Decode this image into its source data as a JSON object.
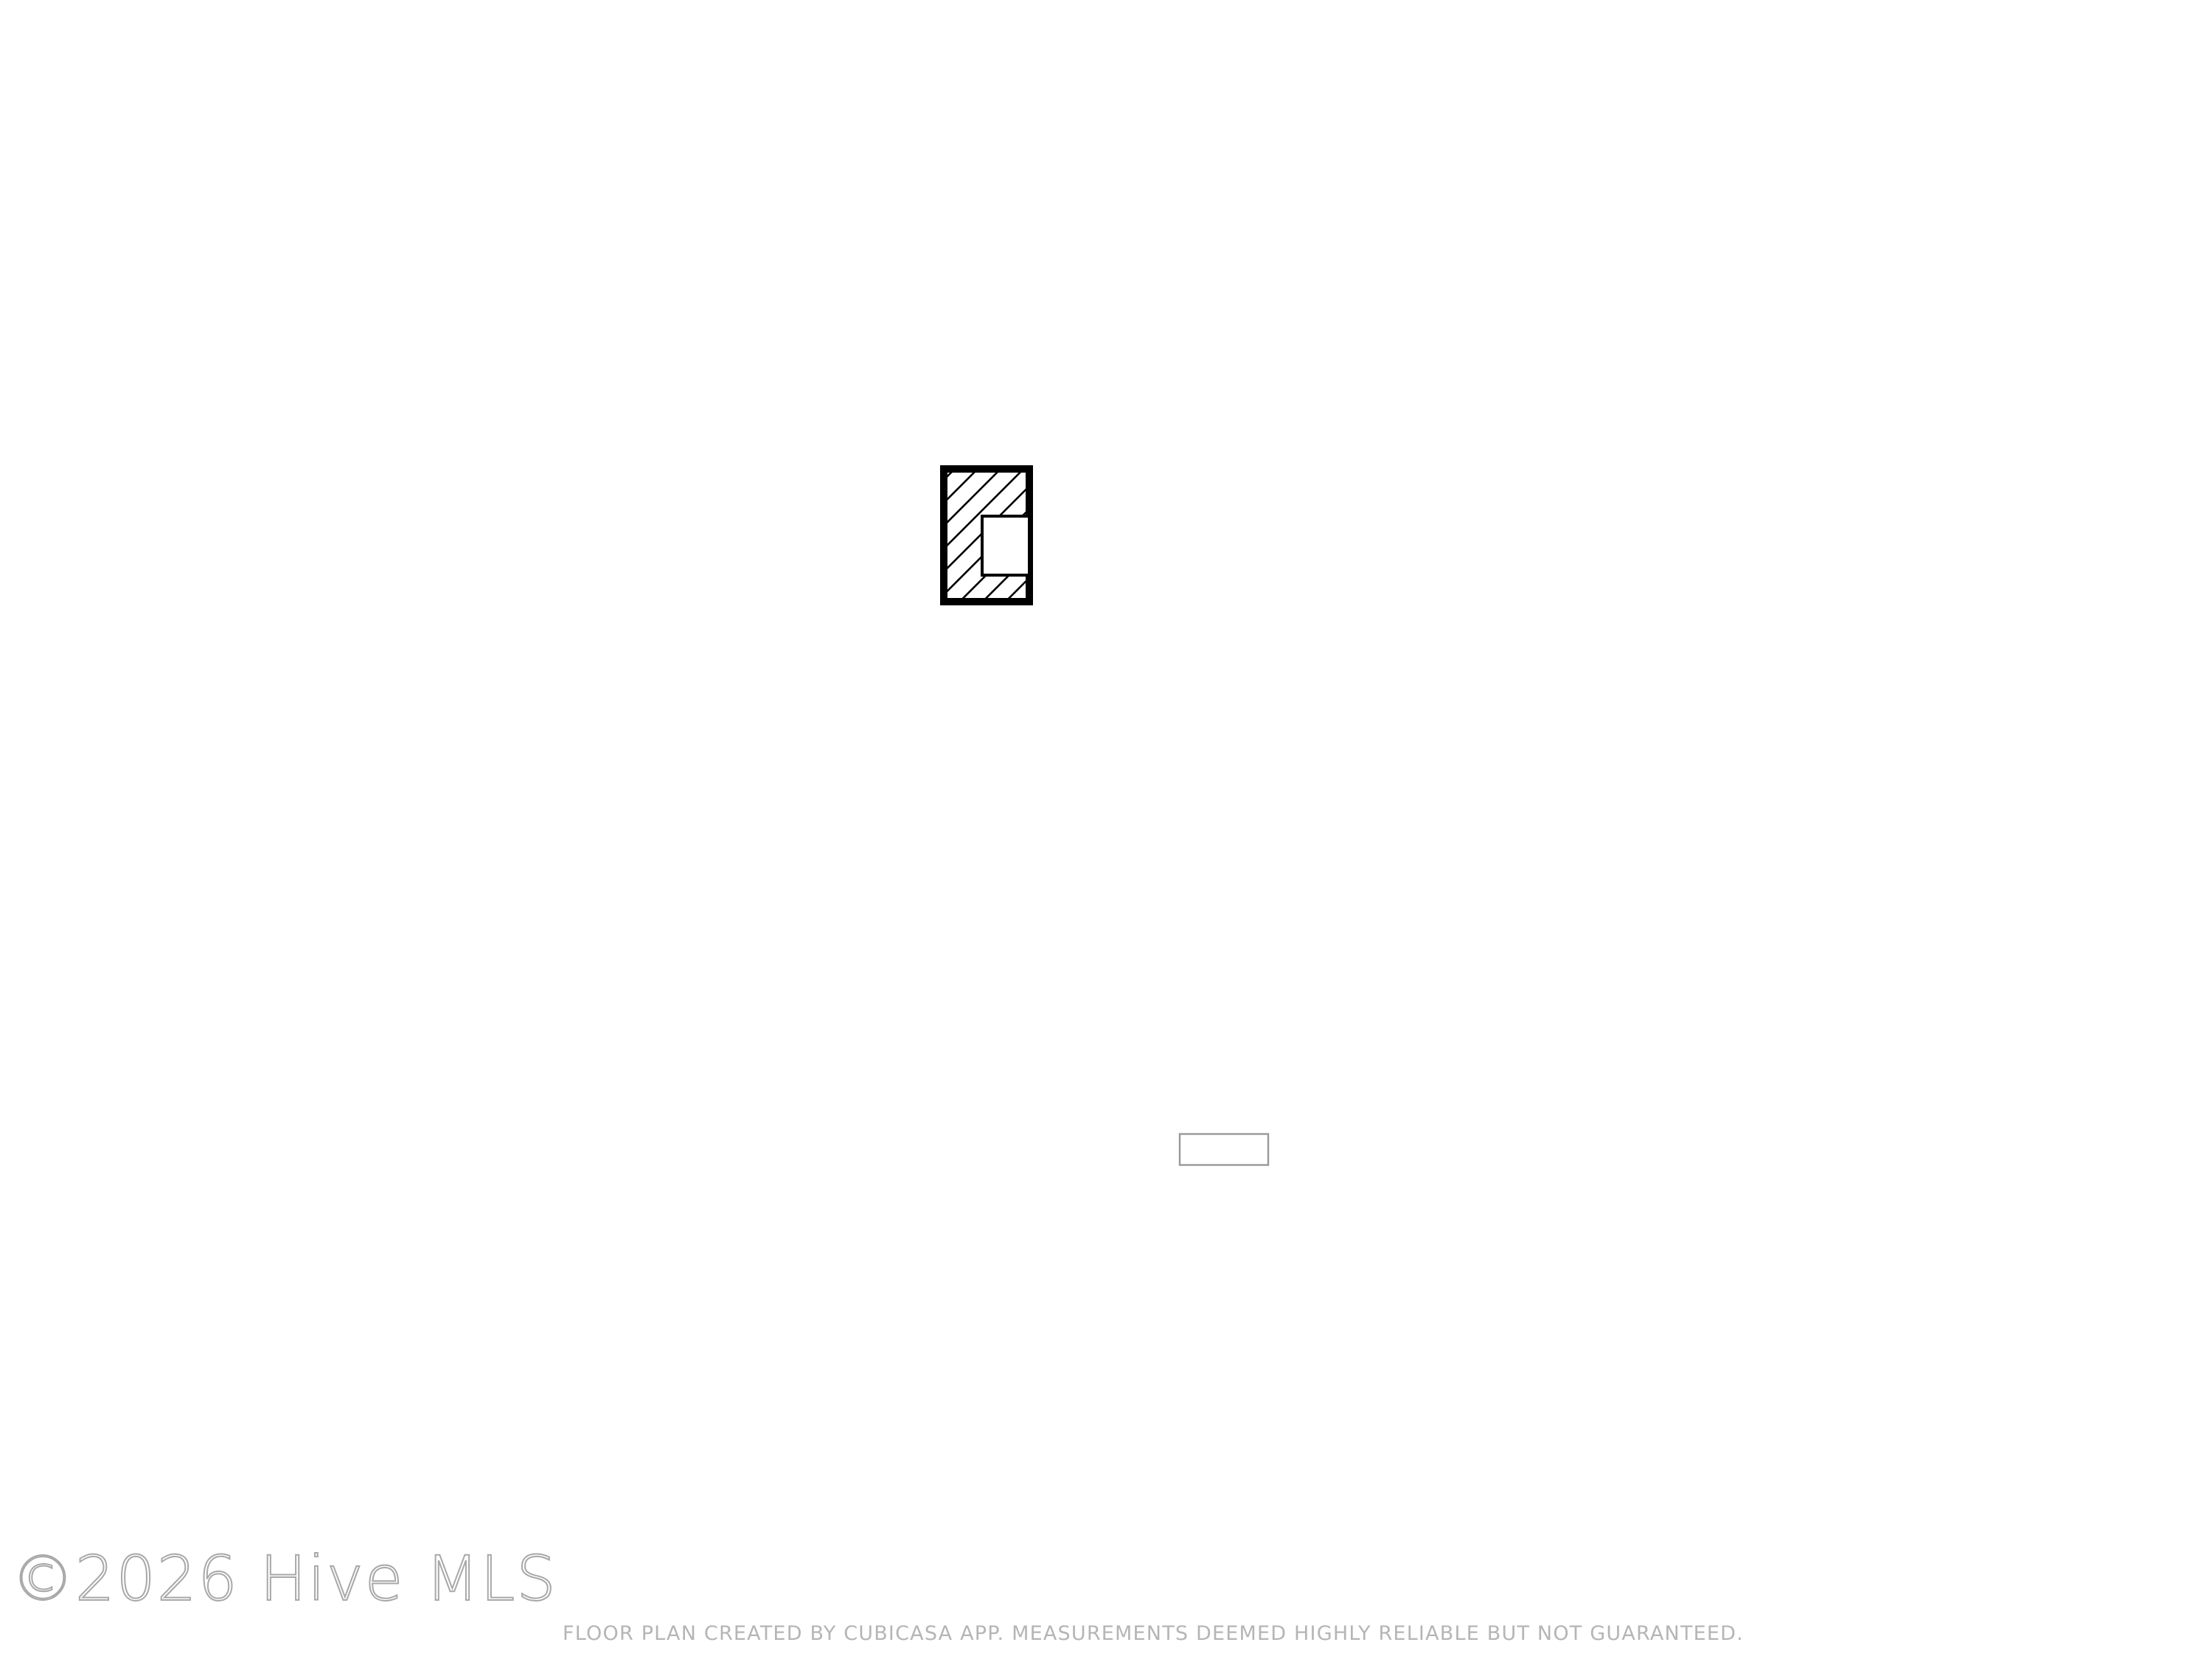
{
  "floor_plan": {
    "rooms": [
      {
        "name": "BREAKFAST NOOK",
        "dims": "8'8\" x 5'9\""
      },
      {
        "name": "KITCHEN",
        "dims": "17'8\" x 16'2\""
      },
      {
        "name": "LIVING ROOM",
        "dims": "14'5\" x 17'8\""
      },
      {
        "name": "PRIMARY BEDROOM",
        "dims": "17'10\" x 17'11\""
      },
      {
        "name": "LAUNDRY",
        "dims": "3'2\" x 5'8\""
      },
      {
        "name": "W.I.C.",
        "dims": "5'3\" x 7'3\""
      },
      {
        "name": "BATH",
        "dims": "8'10\" x 8'5\""
      },
      {
        "name": "HALL",
        "dims": "7'8\" x 8'9\""
      },
      {
        "name": "FOYER",
        "dims": "5'10\" x 9'10\""
      },
      {
        "name": "DINING AREA",
        "dims": "10'9\" x 13'4\""
      },
      {
        "name": "HALL",
        "dims": "7'6\" x 5'1\""
      },
      {
        "name": "BATH",
        "dims": "10'0\" x 4'11\""
      },
      {
        "name": "GARAGE",
        "dims": "18'9\" x 19'11\""
      },
      {
        "name": "BEDROOM",
        "dims": "11'0\" x 11'1\""
      },
      {
        "name": "BEDROOM",
        "dims": "10'10\" x 12'2\""
      }
    ],
    "watermark": "©2026 Hive MLS",
    "footer": "FLOOR PLAN CREATED BY CUBICASA APP. MEASUREMENTS DEEMED HIGHLY RELIABLE BUT NOT GUARANTEED.",
    "colors": {
      "wall": "#000000",
      "label": "#3b3b3b",
      "watermark_stroke": "#a8a8a8",
      "footer_text": "#b5b5b5",
      "background": "#ffffff"
    }
  }
}
